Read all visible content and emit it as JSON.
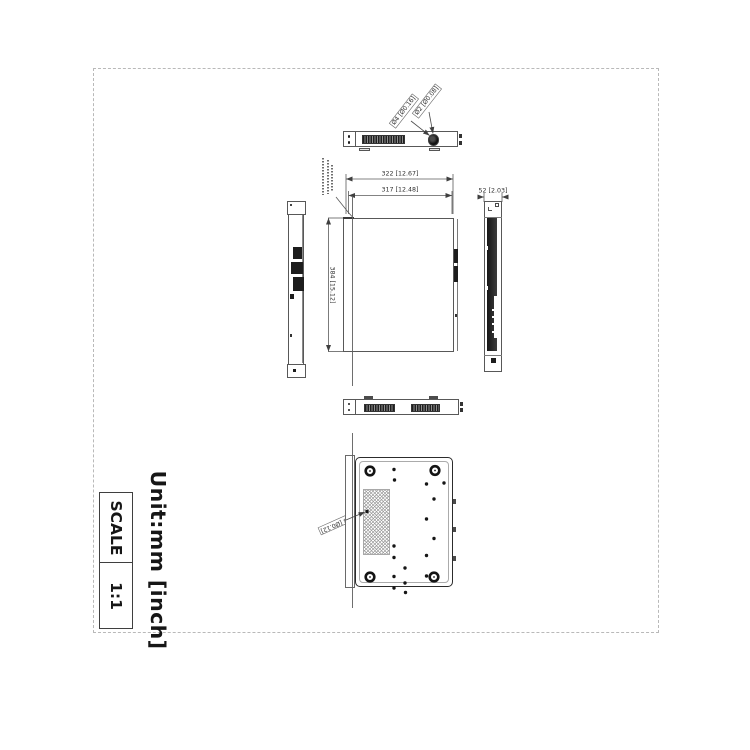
{
  "drawing": {
    "unit_label": "Unit:mm [inch]",
    "scale": {
      "label": "SCALE",
      "value": "1:1"
    },
    "dimensions": {
      "overall_width": "322 [12.67]",
      "inner_width": "317 [12.48]",
      "side_depth": "52 [2.03]",
      "overall_depth": "384 [15.12]"
    },
    "callouts": {
      "knob_outer_dia": "Ø4 [Ø0.16]",
      "knob_inner_dia": "Ø2 [Ø0.08]",
      "bottom_hole_dia": "Ø3 [Ø0.12]"
    }
  }
}
